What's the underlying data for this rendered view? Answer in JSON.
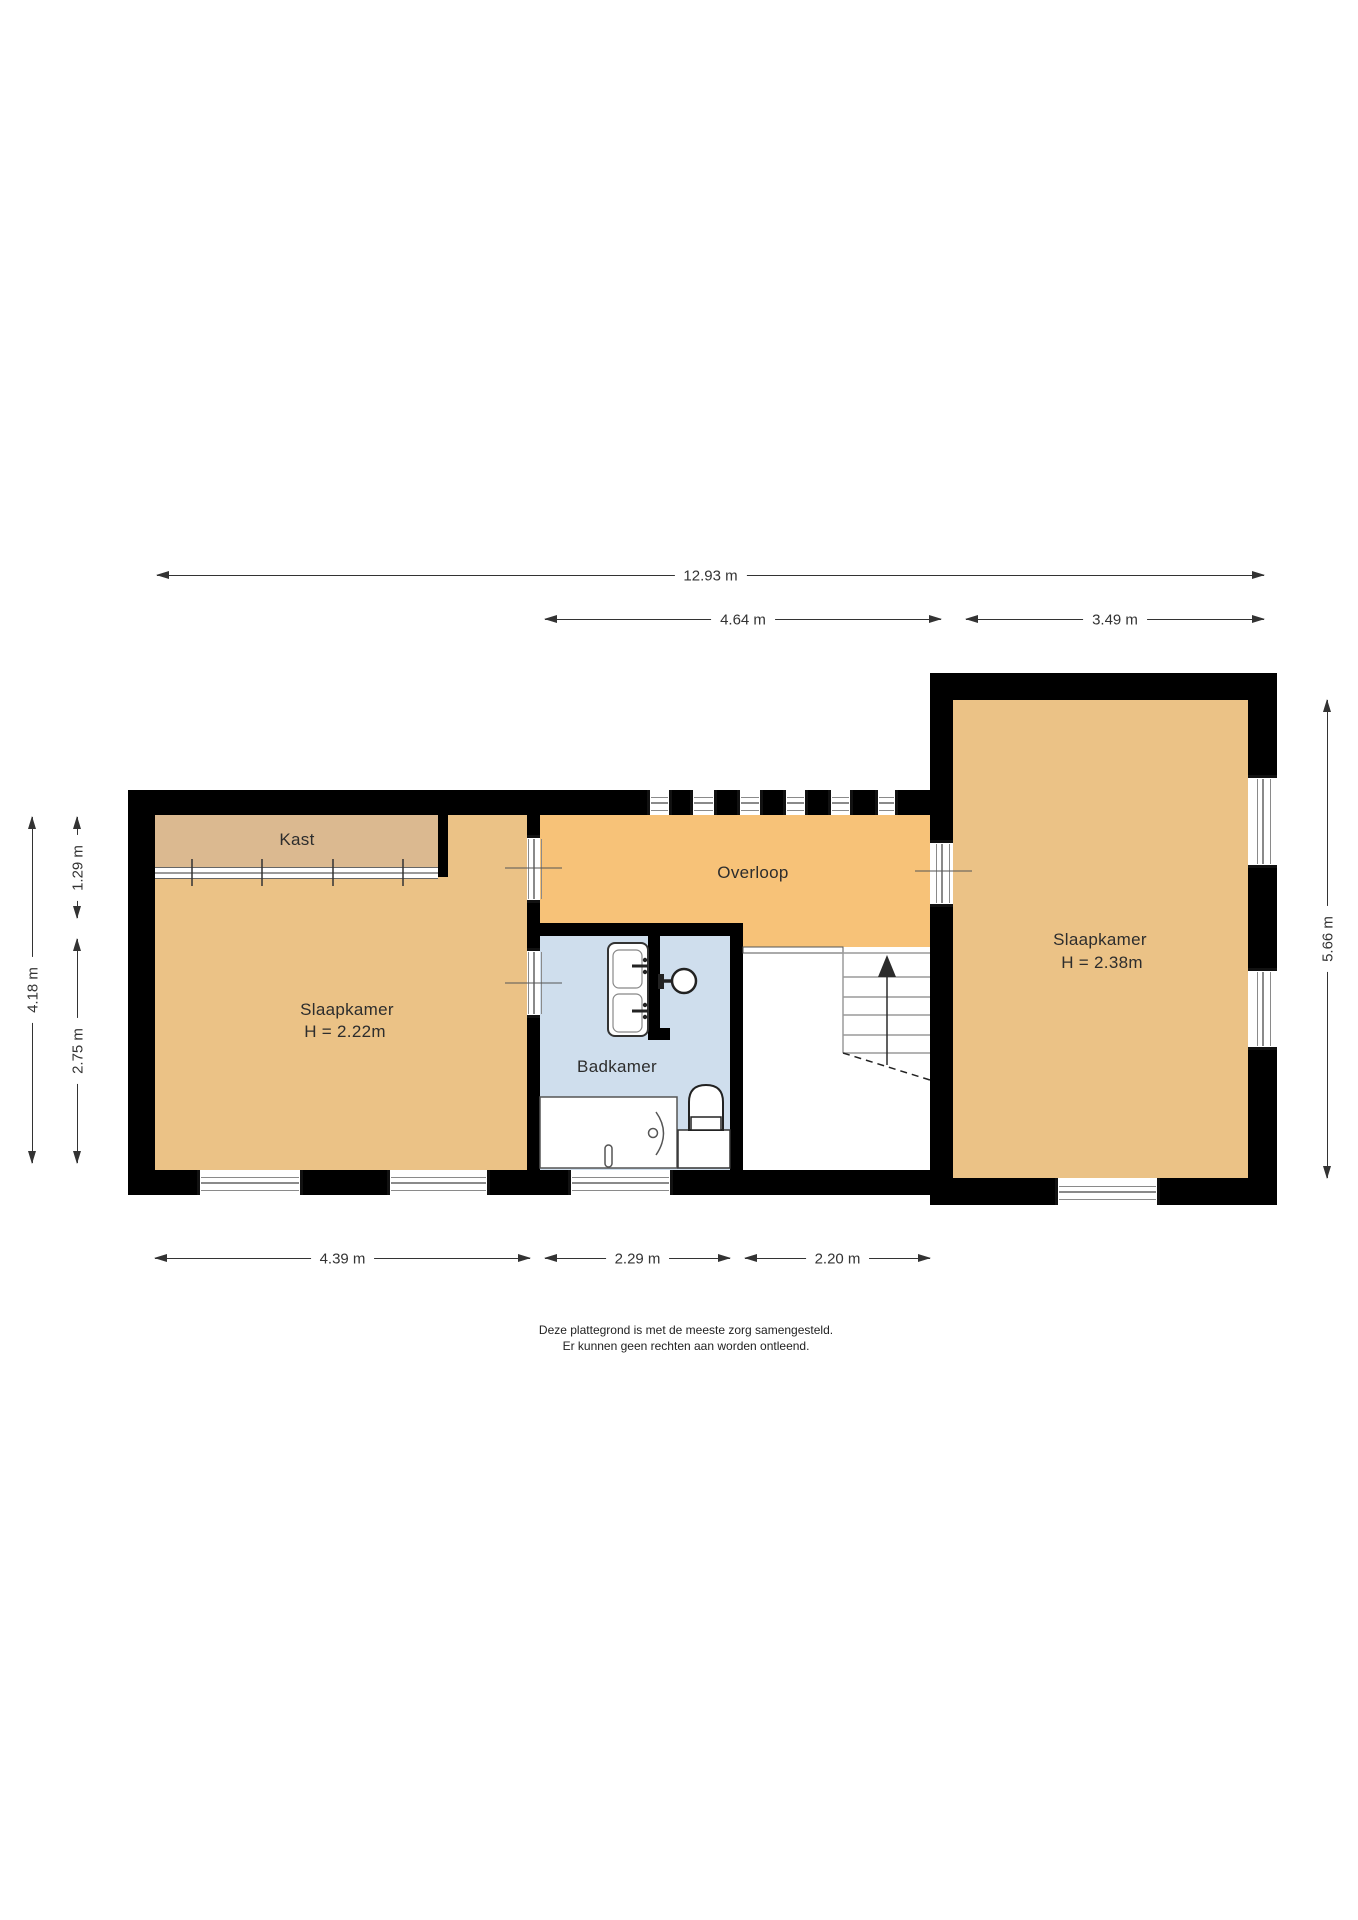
{
  "rooms": {
    "kast": {
      "label": "Kast"
    },
    "slaapkamer_left": {
      "label": "Slaapkamer",
      "height": "H = 2.22m"
    },
    "overloop": {
      "label": "Overloop"
    },
    "badkamer": {
      "label": "Badkamer"
    },
    "slaapkamer_right": {
      "label": "Slaapkamer",
      "height": "H = 2.38m"
    }
  },
  "dimensions": {
    "top_total": "12.93 m",
    "top_middle": "4.64 m",
    "top_right": "3.49 m",
    "bottom_left": "4.39 m",
    "bottom_middle": "2.29 m",
    "bottom_right": "2.20 m",
    "left_total": "4.18 m",
    "left_upper": "1.29 m",
    "left_lower": "2.75 m",
    "right_total": "5.66 m"
  },
  "disclaimer": {
    "line1": "Deze plattegrond is met de meeste zorg samengesteld.",
    "line2": "Er kunnen geen rechten aan worden ontleend."
  },
  "fixtures": {
    "bathtub": "bathtub-icon",
    "toilet": "toilet-icon",
    "double_washbasin": "double-washbasin-icon",
    "shower_head": "shower-head-icon",
    "stairs_up_arrow": "stairs-up-icon",
    "closet_rail": "closet-rail-icon"
  },
  "colors": {
    "wall": "#000000",
    "bedroom_floor": "#ebc286",
    "kast_floor": "#dbb990",
    "overloop_floor": "#f7c278",
    "badkamer_floor": "#cfdeed",
    "window_line": "#8a8a8a",
    "dimension": "#333333"
  }
}
